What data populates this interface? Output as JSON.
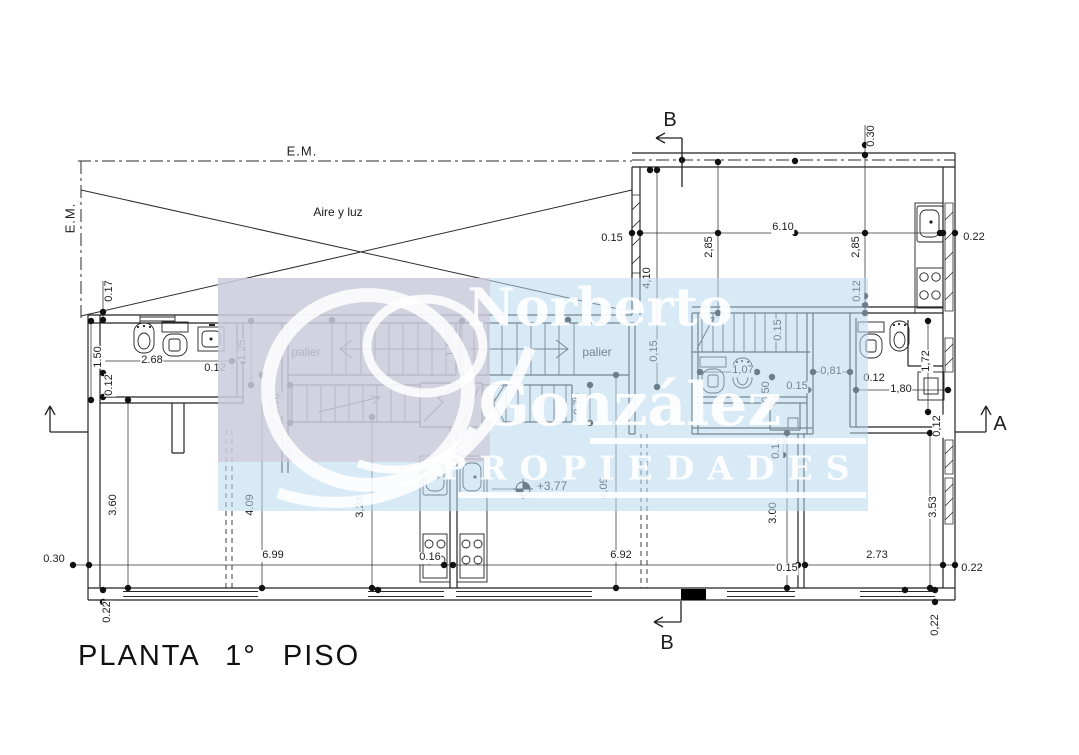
{
  "title": "PLANTA 1° PISO",
  "watermark": {
    "line1": "Norberto",
    "line2": "González",
    "line3": "PROPIEDADES"
  },
  "annotations": {
    "em_top": "E.M.",
    "em_left": "E.M.",
    "aire_y_luz": "Aire y luz",
    "palier_left": "palier",
    "palier_right": "palier",
    "level_mark": "+3.77",
    "section_b_top": "B",
    "section_b_bottom": "B",
    "section_a": "A"
  },
  "dimensions": [
    {
      "t": "0.30",
      "x": 872,
      "y": 136,
      "r": 1
    },
    {
      "t": "0.15",
      "x": 612,
      "y": 239,
      "r": 0
    },
    {
      "t": "6.10",
      "x": 783,
      "y": 228,
      "r": 0
    },
    {
      "t": "2,85",
      "x": 710,
      "y": 247,
      "r": 1
    },
    {
      "t": "2,85",
      "x": 857,
      "y": 247,
      "r": 1
    },
    {
      "t": "4,10",
      "x": 648,
      "y": 278,
      "r": 1
    },
    {
      "t": "0.22",
      "x": 974,
      "y": 238,
      "r": 0
    },
    {
      "t": "0.12",
      "x": 858,
      "y": 291,
      "r": 1
    },
    {
      "t": "0.17",
      "x": 110,
      "y": 291,
      "r": 1
    },
    {
      "t": "1.50",
      "x": 99,
      "y": 357,
      "r": 1
    },
    {
      "t": "0.12",
      "x": 110,
      "y": 385,
      "r": 1
    },
    {
      "t": "2.68",
      "x": 152,
      "y": 361,
      "r": 0
    },
    {
      "t": "0.12",
      "x": 215,
      "y": 369,
      "r": 0
    },
    {
      "t": "1.25",
      "x": 243,
      "y": 350,
      "r": 1
    },
    {
      "t": "1,10",
      "x": 452,
      "y": 346,
      "r": 1
    },
    {
      "t": "0.70",
      "x": 277,
      "y": 404,
      "r": 1
    },
    {
      "t": "0.70",
      "x": 579,
      "y": 404,
      "r": 1
    },
    {
      "t": "0,15",
      "x": 655,
      "y": 351,
      "r": 1
    },
    {
      "t": "0.15",
      "x": 779,
      "y": 330,
      "r": 1
    },
    {
      "t": "1,07",
      "x": 743,
      "y": 371,
      "r": 0
    },
    {
      "t": "0,50",
      "x": 767,
      "y": 392,
      "r": 1
    },
    {
      "t": "0.15",
      "x": 797,
      "y": 387,
      "r": 0
    },
    {
      "t": "0,81",
      "x": 831,
      "y": 372,
      "r": 0
    },
    {
      "t": "0.12",
      "x": 874,
      "y": 379,
      "r": 0
    },
    {
      "t": "1,80",
      "x": 901,
      "y": 390,
      "r": 0
    },
    {
      "t": "1,72",
      "x": 927,
      "y": 361,
      "r": 1
    },
    {
      "t": "0,12",
      "x": 938,
      "y": 426,
      "r": 1
    },
    {
      "t": "0.12",
      "x": 777,
      "y": 448,
      "r": 1
    },
    {
      "t": "3.60",
      "x": 114,
      "y": 505,
      "r": 1
    },
    {
      "t": "4.09",
      "x": 251,
      "y": 505,
      "r": 1
    },
    {
      "t": "3,24",
      "x": 361,
      "y": 507,
      "r": 1
    },
    {
      "t": "4.09",
      "x": 605,
      "y": 488,
      "r": 1
    },
    {
      "t": "3.00",
      "x": 774,
      "y": 513,
      "r": 1
    },
    {
      "t": "3.53",
      "x": 934,
      "y": 507,
      "r": 1
    },
    {
      "t": "0.30",
      "x": 54,
      "y": 560,
      "r": 0
    },
    {
      "t": "6.99",
      "x": 273,
      "y": 556,
      "r": 0
    },
    {
      "t": "0.16",
      "x": 430,
      "y": 558,
      "r": 0
    },
    {
      "t": "6.92",
      "x": 621,
      "y": 556,
      "r": 0
    },
    {
      "t": "0.15",
      "x": 787,
      "y": 569,
      "r": 0
    },
    {
      "t": "2.73",
      "x": 877,
      "y": 556,
      "r": 0
    },
    {
      "t": "0.22",
      "x": 972,
      "y": 569,
      "r": 0
    },
    {
      "t": "0.22",
      "x": 108,
      "y": 612,
      "r": 1
    },
    {
      "t": "0,22",
      "x": 936,
      "y": 625,
      "r": 1
    }
  ]
}
